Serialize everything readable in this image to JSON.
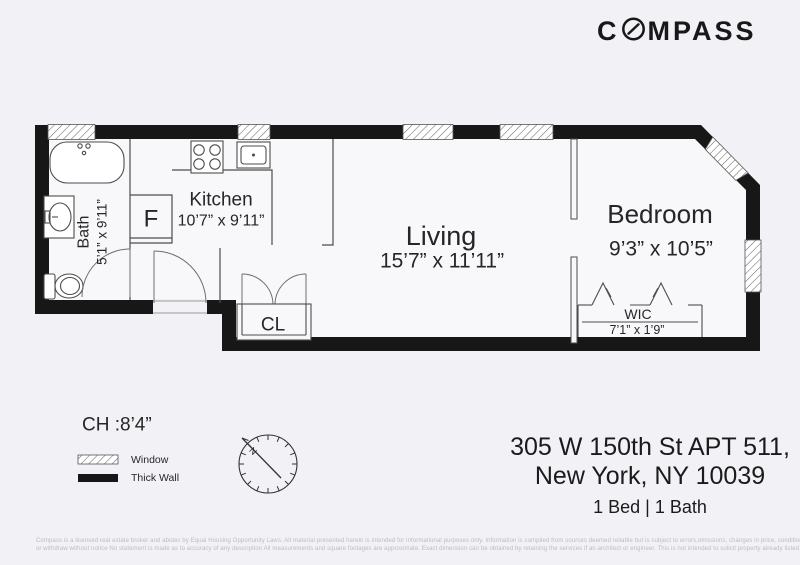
{
  "header": {
    "brand_prefix": "C",
    "brand_suffix": "MPASS"
  },
  "plan": {
    "rooms": {
      "bath": {
        "label": "Bath",
        "dims": "5’1” x 9’11”"
      },
      "kitchen": {
        "label": "Kitchen",
        "dims": "10’7” x 9’11”"
      },
      "living": {
        "label": "Living",
        "dims": "15’7” x 11’11”"
      },
      "bedroom": {
        "label": "Bedroom",
        "dims": "9’3” x 10’5”"
      },
      "wic": {
        "label": "WIC",
        "dims": "7’1” x 1’9”"
      },
      "closet": {
        "label": "CL"
      },
      "fridge": {
        "label": "F"
      }
    },
    "ceiling_height": "CH :8’4”",
    "compass_north": "N"
  },
  "legend": {
    "window": "Window",
    "thick_wall": "Thick Wall"
  },
  "listing": {
    "address_line1": "305 W 150th St APT 511,",
    "address_line2": "New York, NY 10039",
    "summary": "1 Bed | 1 Bath"
  },
  "disclaimer": {
    "line1": "Compass is a licensed real estate broker and abides by Equal Housing Opportunity Laws. All material presented herein is intended for informational purposes only. Information is compiled from sources deemed reliable but is subject to errors,omissions, changes in price, condition,sale",
    "line2": "or withdraw without notice No statement is made as to accuracy of any description All measurements and square footages are approximate. Exact dimension can be obtained by retaining the services if an architect or engineer. This is not intended to solicit property already listed."
  },
  "colors": {
    "background": "#f2f1f6",
    "interior": "#f8f8fb",
    "wall": "#171717",
    "thin_line": "#4d4d4d",
    "text": "#1f1f1f",
    "muted_text": "#b9bcc6"
  }
}
